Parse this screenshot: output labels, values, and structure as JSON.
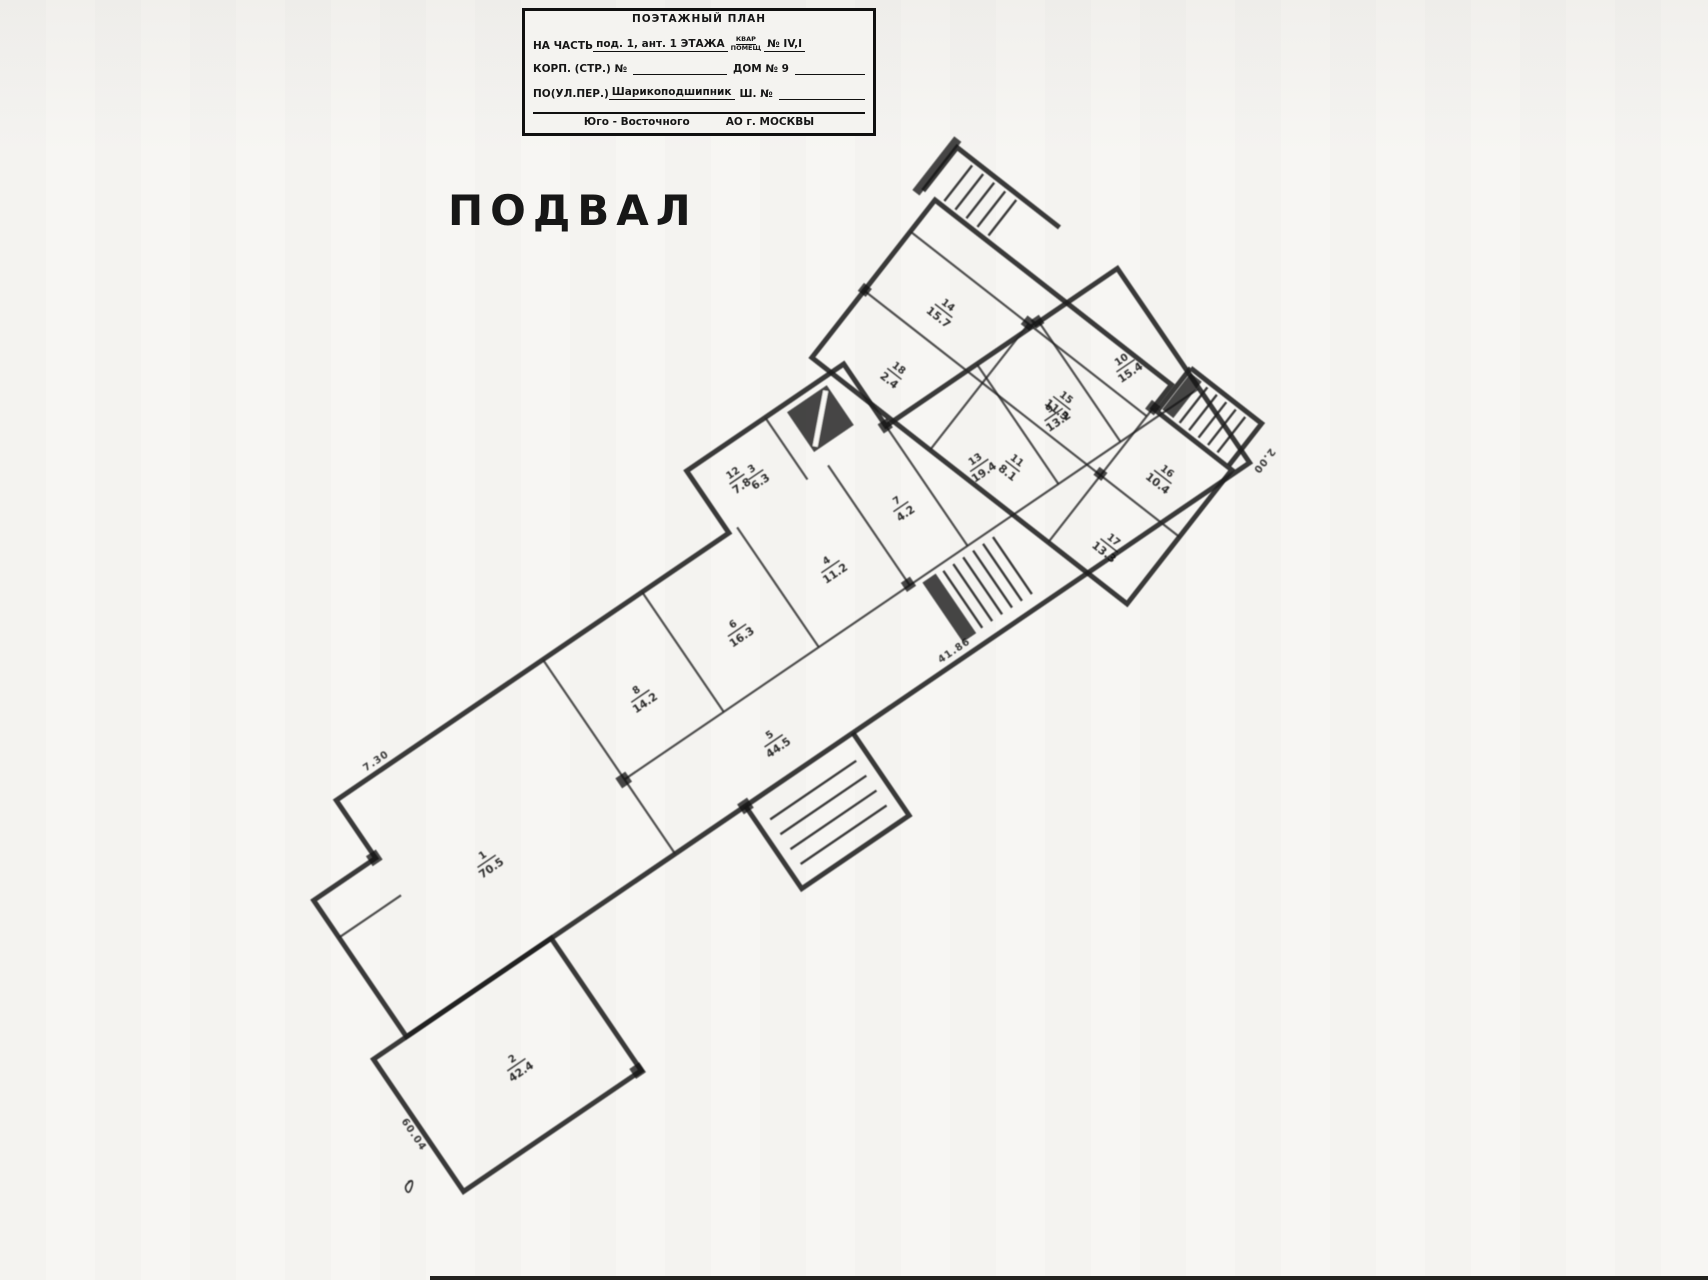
{
  "title_block": {
    "title": "ПОЭТАЖНЫЙ ПЛАН",
    "row_part": {
      "label": "НА ЧАСТЬ",
      "value": "под. 1, ант. 1 ЭТАЖА",
      "apt_label_top": "КВАР",
      "apt_label_bottom": "ПОМЕЩ",
      "apt_no": "№ IV,I"
    },
    "row_building": {
      "label": "КОРП. (СТР.) №",
      "house_label": "ДОМ № 9"
    },
    "row_street": {
      "label": "ПО(УЛ.ПЕР.)",
      "value": "Шарикоподшипник",
      "sh_label": "Ш. №"
    },
    "row_district": {
      "left": "Юго - Восточного",
      "right": "АО г. МОСКВЫ"
    }
  },
  "plan": {
    "floor_label": "ПОДВАЛ",
    "rooms": [
      {
        "num": "1",
        "area": "70.5"
      },
      {
        "num": "2",
        "area": "42.4"
      },
      {
        "num": "8",
        "area": "14.2"
      },
      {
        "num": "6",
        "area": "16.3"
      },
      {
        "num": "4",
        "area": "11.2"
      },
      {
        "num": "7",
        "area": "4.2"
      },
      {
        "num": "5",
        "area": "44.5"
      },
      {
        "num": "13",
        "area": "19.4"
      },
      {
        "num": "9",
        "area": "13.2"
      },
      {
        "num": "10",
        "area": "15.4"
      },
      {
        "num": "3",
        "area": "6.3"
      },
      {
        "num": "12",
        "area": "7.8"
      },
      {
        "num": "14",
        "area": "15.7"
      },
      {
        "num": "15",
        "area": "11.3"
      },
      {
        "num": "18",
        "area": "2.4"
      },
      {
        "num": "11",
        "area": "8.1"
      },
      {
        "num": "16",
        "area": "10.4"
      },
      {
        "num": "17",
        "area": "13.3"
      }
    ],
    "dimensions": [
      "41.86",
      "60.04",
      "7.30",
      "2.00"
    ]
  }
}
